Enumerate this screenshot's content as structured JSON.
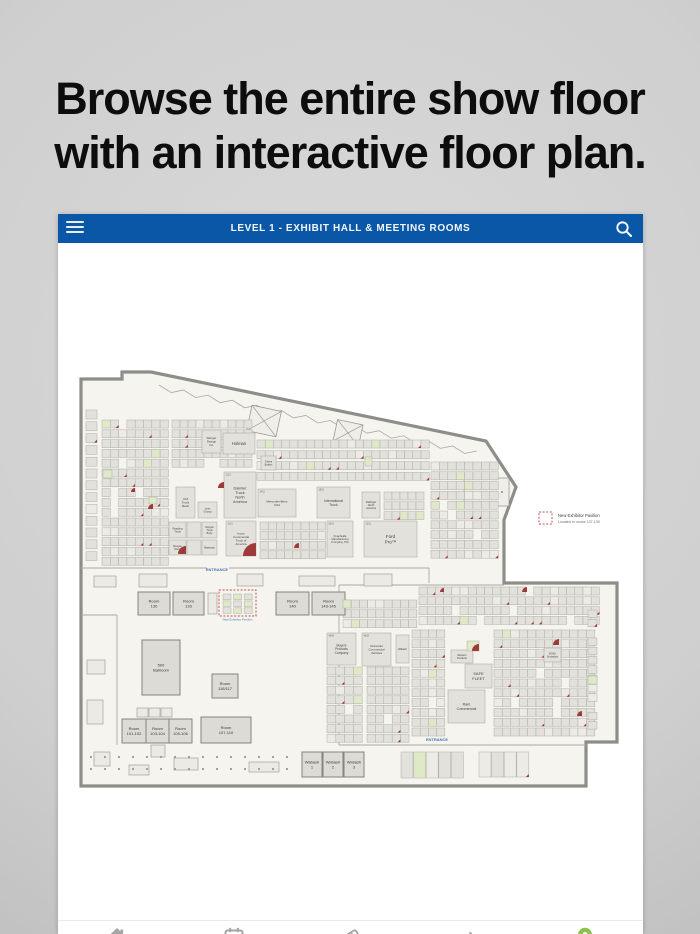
{
  "headline": {
    "line1": "Browse the entire show floor",
    "line2": "with an interactive floor plan."
  },
  "app": {
    "header": {
      "title": "LEVEL 1 - EXHIBIT HALL & MEETING ROOMS",
      "bg_color": "#0b57a7",
      "icons": [
        "hamburger-icon",
        "search-icon"
      ]
    },
    "nav": {
      "items": [
        {
          "icon": "home-icon",
          "color": "#a5a5a5"
        },
        {
          "icon": "calendar-icon",
          "color": "#a5a5a5"
        },
        {
          "icon": "tickets-icon",
          "color": "#a5a5a5"
        },
        {
          "icon": "beacon-icon",
          "color": "#a5a5a5"
        },
        {
          "icon": "location-pin-icon",
          "color": "#8bc34a"
        }
      ]
    }
  },
  "legend": {
    "title": "New Exhibitor Pavilion",
    "subtitle": "Located in rooms 137-139",
    "swatch_color": "#c2504f"
  },
  "floorplan": {
    "colors": {
      "floor": "#f5f4ee",
      "wall": "#8d8d89",
      "booth": "#e2e1db",
      "booth_stroke": "#aeada6",
      "booth_pale": "#edebe5",
      "room": "#dcdbd5",
      "room_stroke": "#85847e",
      "green": "#dfe9c8",
      "red": "#9e3a3a",
      "blue_text": "#4a72b8",
      "label": "#45433c",
      "num": "#6a6860"
    },
    "outline_points": "82,379 123,379 123,372 152,372 487,441 517,487 505,520 505,583 618,583 618,742 587,742 587,786 82,786",
    "walls": [
      {
        "x1": 82,
        "y1": 568,
        "x2": 208,
        "y2": 568
      },
      {
        "x1": 230,
        "y1": 568,
        "x2": 430,
        "y2": 568
      },
      {
        "x1": 430,
        "y1": 568,
        "x2": 430,
        "y2": 583
      },
      {
        "x1": 340,
        "y1": 585,
        "x2": 505,
        "y2": 585
      },
      {
        "x1": 340,
        "y1": 585,
        "x2": 340,
        "y2": 745
      },
      {
        "x1": 340,
        "y1": 745,
        "x2": 587,
        "y2": 745
      },
      {
        "x1": 118,
        "y1": 615,
        "x2": 118,
        "y2": 745
      },
      {
        "x1": 82,
        "y1": 615,
        "x2": 118,
        "y2": 615
      }
    ],
    "sawtooth": {
      "x1": 160,
      "y1": 385,
      "x2": 478,
      "y2": 451,
      "teeth": 26,
      "amp": 5
    },
    "hatches": [
      {
        "x": 250,
        "y": 408,
        "w": 30,
        "h": 26,
        "r": 12
      },
      {
        "x": 336,
        "y": 422,
        "w": 26,
        "h": 22,
        "r": 12
      }
    ],
    "tip_room": {
      "x": 465,
      "y": 478,
      "w": 45,
      "h": 28
    },
    "misc_rects": [
      {
        "x": 95,
        "y": 576,
        "w": 22,
        "h": 11
      },
      {
        "x": 140,
        "y": 574,
        "w": 28,
        "h": 13
      },
      {
        "x": 238,
        "y": 574,
        "w": 26,
        "h": 12
      },
      {
        "x": 300,
        "y": 576,
        "w": 36,
        "h": 10
      },
      {
        "x": 365,
        "y": 574,
        "w": 28,
        "h": 12
      },
      {
        "x": 88,
        "y": 660,
        "w": 18,
        "h": 14
      },
      {
        "x": 88,
        "y": 700,
        "w": 16,
        "h": 24
      },
      {
        "x": 95,
        "y": 752,
        "w": 16,
        "h": 14
      },
      {
        "x": 130,
        "y": 765,
        "w": 20,
        "h": 10
      },
      {
        "x": 175,
        "y": 758,
        "w": 24,
        "h": 12
      },
      {
        "x": 250,
        "y": 762,
        "w": 30,
        "h": 10
      },
      {
        "x": 152,
        "y": 745,
        "w": 14,
        "h": 12
      },
      {
        "x": 138,
        "y": 708,
        "w": 11,
        "h": 9
      },
      {
        "x": 150,
        "y": 708,
        "w": 11,
        "h": 9
      },
      {
        "x": 162,
        "y": 708,
        "w": 11,
        "h": 9
      },
      {
        "x": 209,
        "y": 593,
        "w": 9,
        "h": 21
      }
    ],
    "grids": [
      {
        "x": 87,
        "y": 410,
        "cols": 1,
        "rows": 13,
        "cw": 11,
        "ch": 9,
        "sx": 11,
        "sy": 11.8
      },
      {
        "x": 103,
        "y": 420,
        "cols": 8,
        "rows": 15,
        "cw": 8.3,
        "ch": 8,
        "sx": 8.3,
        "sy": 9.8
      },
      {
        "x": 173,
        "y": 420,
        "cols": 10,
        "rows": 5,
        "cw": 8,
        "ch": 8,
        "sx": 8,
        "sy": 9.8
      },
      {
        "x": 258,
        "y": 440,
        "cols": 21,
        "rows": 4,
        "cw": 8.2,
        "ch": 8,
        "sx": 8.2,
        "sy": 10.8
      },
      {
        "x": 261,
        "y": 522,
        "cols": 8,
        "rows": 4,
        "cw": 8.2,
        "ch": 8,
        "sx": 8.2,
        "sy": 9.6
      },
      {
        "x": 385,
        "y": 492,
        "cols": 5,
        "rows": 3,
        "cw": 8,
        "ch": 8,
        "sx": 8,
        "sy": 9.8
      },
      {
        "x": 432,
        "y": 462,
        "cols": 8,
        "rows": 10,
        "cw": 8.4,
        "ch": 8,
        "sx": 8.4,
        "sy": 9.8
      },
      {
        "x": 420,
        "y": 587,
        "cols": 22,
        "rows": 4,
        "cw": 8.2,
        "ch": 8,
        "sx": 8.2,
        "sy": 9.8
      },
      {
        "x": 344,
        "y": 600,
        "cols": 9,
        "rows": 3,
        "cw": 8.2,
        "ch": 8,
        "sx": 8.2,
        "sy": 9.8
      },
      {
        "x": 495,
        "y": 630,
        "cols": 12,
        "rows": 11,
        "cw": 8.4,
        "ch": 8,
        "sx": 8.4,
        "sy": 9.8
      },
      {
        "x": 413,
        "y": 630,
        "cols": 4,
        "rows": 11,
        "cw": 8.2,
        "ch": 8,
        "sx": 8.2,
        "sy": 9.8
      },
      {
        "x": 328,
        "y": 667,
        "cols": 4,
        "rows": 8,
        "cw": 8.8,
        "ch": 8,
        "sx": 8.8,
        "sy": 9.6
      },
      {
        "x": 368,
        "y": 667,
        "cols": 5,
        "rows": 8,
        "cw": 8.4,
        "ch": 8,
        "sx": 8.4,
        "sy": 9.6
      },
      {
        "x": 589,
        "y": 610,
        "cols": 1,
        "rows": 13,
        "cw": 9,
        "ch": 7.5,
        "sx": 9,
        "sy": 9.3
      },
      {
        "x": 402,
        "y": 752,
        "cols": 5,
        "rows": 1,
        "cw": 12,
        "ch": 26,
        "sx": 12.6,
        "sy": 27
      },
      {
        "x": 480,
        "y": 752,
        "cols": 4,
        "rows": 1,
        "cw": 12,
        "ch": 25,
        "sx": 12.6,
        "sy": 26
      }
    ],
    "dots": {
      "x": 92,
      "y": 757,
      "cols": 15,
      "rows": 2,
      "sx": 14,
      "sy": 12,
      "r": 1.1
    },
    "booths": [
      {
        "x": 203,
        "y": 430,
        "w": 19,
        "h": 23,
        "label": "Ranger\nDesign\nInc.",
        "fs": 3
      },
      {
        "x": 224,
        "y": 433,
        "w": 32,
        "h": 21,
        "label": "Holman",
        "fs": 4.2
      },
      {
        "x": 262,
        "y": 456,
        "w": 15,
        "h": 14,
        "label": "Toteva\nBodies",
        "fs": 2.5
      },
      {
        "x": 225,
        "y": 472,
        "w": 32,
        "h": 46,
        "label": "Daimler\nTruck\nNorth\nAmerica",
        "fs": 3.8,
        "num": "1121"
      },
      {
        "x": 177,
        "y": 487,
        "w": 19,
        "h": 31,
        "label": "CM\nTruck\nBeds",
        "fs": 3
      },
      {
        "x": 199,
        "y": 502,
        "w": 19,
        "h": 16,
        "label": "Leer\nGroup",
        "fs": 2.8
      },
      {
        "x": 259,
        "y": 489,
        "w": 38,
        "h": 28,
        "label": "Mercedes-Benz\nUSA",
        "fs": 3,
        "num": "1401"
      },
      {
        "x": 318,
        "y": 487,
        "w": 33,
        "h": 31,
        "label": "International\nTruck",
        "fs": 3.4,
        "num": "1501"
      },
      {
        "x": 363,
        "y": 492,
        "w": 18,
        "h": 26,
        "label": "Palfinger\nNorth\nAmerica",
        "fs": 2.7
      },
      {
        "x": 328,
        "y": 521,
        "w": 26,
        "h": 36,
        "label": "Knapheide\nManufacturing\nCompany, The",
        "fs": 2.7,
        "num": "2001"
      },
      {
        "x": 365,
        "y": 521,
        "w": 53,
        "h": 36,
        "label": "Ford\nPro™",
        "fs": 4.6,
        "num": "2201"
      },
      {
        "x": 170,
        "y": 522,
        "w": 17,
        "h": 16,
        "label": "Reading\nTruck",
        "fs": 2.7
      },
      {
        "x": 188,
        "y": 522,
        "w": 14,
        "h": 16,
        "label": "",
        "fs": 2.6
      },
      {
        "x": 203,
        "y": 522,
        "w": 15,
        "h": 16,
        "label": "Morgan\nTruck\nBody",
        "fs": 2.5
      },
      {
        "x": 170,
        "y": 540,
        "w": 17,
        "h": 15,
        "label": "Morgan\nOlson",
        "fs": 2.6
      },
      {
        "x": 188,
        "y": 540,
        "w": 14,
        "h": 15,
        "label": "",
        "fs": 2.6
      },
      {
        "x": 203,
        "y": 540,
        "w": 15,
        "h": 15,
        "label": "Masterack",
        "fs": 2.3
      },
      {
        "x": 227,
        "y": 521,
        "w": 30,
        "h": 35,
        "label": "Isuzu\nCommercial\nTruck of\nAmerica",
        "fs": 3,
        "num": "1101"
      },
      {
        "x": 328,
        "y": 633,
        "w": 29,
        "h": 32,
        "label": "Buyers\nProducts\nCompany",
        "fs": 3.2,
        "num": "4609"
      },
      {
        "x": 363,
        "y": 633,
        "w": 29,
        "h": 33,
        "label": "Chevrolet\nCommercial\nVehicles",
        "fs": 3,
        "num": "4629"
      },
      {
        "x": 397,
        "y": 635,
        "w": 13,
        "h": 28,
        "label": "Wabash",
        "fs": 2.4
      },
      {
        "x": 452,
        "y": 650,
        "w": 22,
        "h": 13,
        "label": "Western\nProducts",
        "fs": 2.5
      },
      {
        "x": 466,
        "y": 664,
        "w": 27,
        "h": 24,
        "label": "SAFE\nFLEET",
        "fs": 4
      },
      {
        "x": 449,
        "y": 690,
        "w": 37,
        "h": 33,
        "label": "Ram\nCommercial",
        "fs": 3.7
      },
      {
        "x": 545,
        "y": 648,
        "w": 17,
        "h": 14,
        "label": "BOSS\nSnowplow",
        "fs": 2.4
      }
    ],
    "rooms": [
      {
        "x": 139,
        "y": 592,
        "w": 32,
        "h": 23,
        "label": "Room\n130"
      },
      {
        "x": 174,
        "y": 592,
        "w": 31,
        "h": 23,
        "label": "Room\n133"
      },
      {
        "x": 277,
        "y": 592,
        "w": 33,
        "h": 23,
        "label": "Room\n140"
      },
      {
        "x": 313,
        "y": 592,
        "w": 33,
        "h": 23,
        "label": "Room\n143-145"
      },
      {
        "x": 143,
        "y": 640,
        "w": 38,
        "h": 55,
        "label": "500\nBallroom"
      },
      {
        "x": 213,
        "y": 674,
        "w": 26,
        "h": 24,
        "label": "Room\n116/117"
      },
      {
        "x": 123,
        "y": 719,
        "w": 24,
        "h": 24,
        "label": "Room\n101-102"
      },
      {
        "x": 147,
        "y": 719,
        "w": 23,
        "h": 24,
        "label": "Room\n103-104"
      },
      {
        "x": 170,
        "y": 719,
        "w": 23,
        "h": 24,
        "label": "Room\n105-106"
      },
      {
        "x": 202,
        "y": 717,
        "w": 50,
        "h": 26,
        "label": "Room\n107-110"
      },
      {
        "x": 303,
        "y": 752,
        "w": 20,
        "h": 25,
        "label": "Wabash\n1"
      },
      {
        "x": 324,
        "y": 752,
        "w": 20,
        "h": 25,
        "label": "Wabash\n2"
      },
      {
        "x": 345,
        "y": 752,
        "w": 20,
        "h": 25,
        "label": "Wabash\n3"
      }
    ],
    "pavilion": {
      "x": 220,
      "y": 590,
      "w": 37,
      "h": 26,
      "label": "New Exhibitor Pavilion"
    },
    "legend_pos": {
      "x": 540,
      "y": 512
    },
    "entrances": [
      {
        "x": 218,
        "y": 571,
        "label": "ENTRANCE"
      },
      {
        "x": 438,
        "y": 741,
        "label": "ENTRANCE"
      }
    ],
    "fans": [
      {
        "x": 257,
        "y": 556,
        "r": 13
      },
      {
        "x": 187,
        "y": 554,
        "r": 8
      },
      {
        "x": 225,
        "y": 488,
        "r": 6
      },
      {
        "x": 154,
        "y": 509,
        "r": 5
      },
      {
        "x": 480,
        "y": 651,
        "r": 7
      },
      {
        "x": 560,
        "y": 645,
        "r": 6
      },
      {
        "x": 300,
        "y": 548,
        "r": 5
      },
      {
        "x": 583,
        "y": 716,
        "r": 5
      },
      {
        "x": 136,
        "y": 492,
        "r": 4
      },
      {
        "x": 445,
        "y": 592,
        "r": 4
      },
      {
        "x": 528,
        "y": 592,
        "r": 5
      }
    ],
    "greens": [
      {
        "x": 104,
        "y": 470,
        "w": 9,
        "h": 8
      },
      {
        "x": 150,
        "y": 497,
        "w": 8,
        "h": 7
      },
      {
        "x": 366,
        "y": 457,
        "w": 7,
        "h": 9
      },
      {
        "x": 468,
        "y": 641,
        "w": 12,
        "h": 10
      },
      {
        "x": 589,
        "y": 676,
        "w": 9,
        "h": 8
      },
      {
        "x": 344,
        "y": 600,
        "w": 8,
        "h": 8
      }
    ]
  }
}
